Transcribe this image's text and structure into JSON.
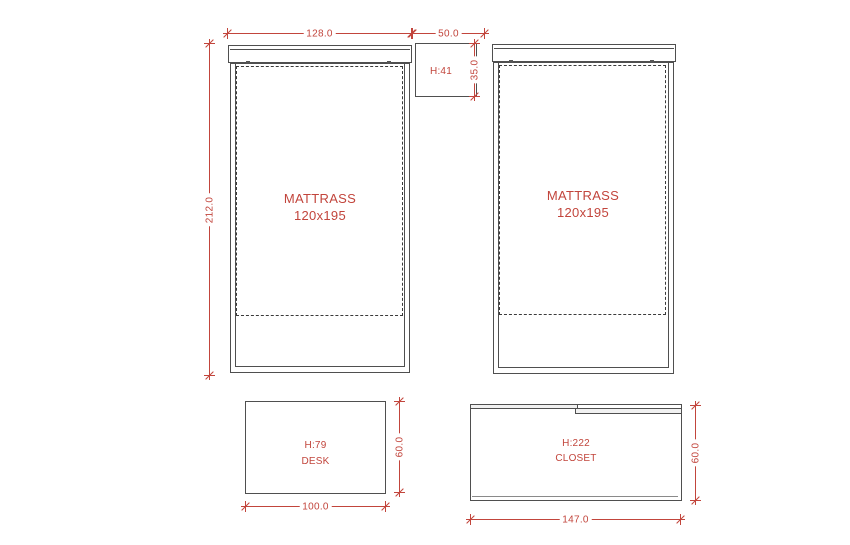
{
  "colors": {
    "background": "#ffffff",
    "outline": "#4f4f4f",
    "dimension": "#c2453c"
  },
  "beds": {
    "left": {
      "name": "MATTRASS",
      "size": "120x195"
    },
    "right": {
      "name": "MATTRASS",
      "size": "120x195"
    }
  },
  "nightstand": {
    "height_label": "H:41"
  },
  "desk": {
    "height_label": "H:79",
    "name": "DESK"
  },
  "closet": {
    "height_label": "H:222",
    "name": "CLOSET"
  },
  "dimensions": {
    "bed_width": "128.0",
    "gap_width": "50.0",
    "bed_length": "212.0",
    "nightstand_depth": "35.0",
    "desk_width": "100.0",
    "desk_depth": "60.0",
    "closet_width": "147.0",
    "closet_depth": "60.0"
  }
}
